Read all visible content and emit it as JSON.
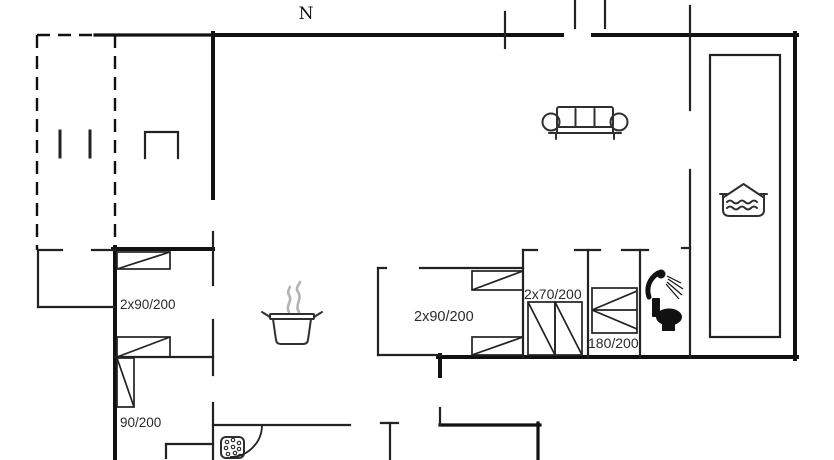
{
  "palette": {
    "background": "#ffffff",
    "wall_line": "#111111",
    "bed_line": "#222222",
    "label_text": "#2b2b2b",
    "steam_gray": "#b4b4b4"
  },
  "compass": {
    "north_label": "N"
  },
  "bed_labels": {
    "left_room_double": "2x90/200",
    "left_room_single": "90/200",
    "middle_room_double": "2x90/200",
    "bunk_room": "2x70/200",
    "double_bed_room": "180/200"
  },
  "icons": {
    "sofa": "sofa-icon",
    "cooking_pot": "cooking-pot-icon",
    "steam": "steam-icon",
    "spa_bath": "spa-bath-icon",
    "shower": "shower-icon",
    "toilet": "toilet-icon",
    "dishwasher": "dishwasher-bubbles-icon",
    "door_swing": "door-swing-arc",
    "carport_posts": "carport-post-icon"
  }
}
